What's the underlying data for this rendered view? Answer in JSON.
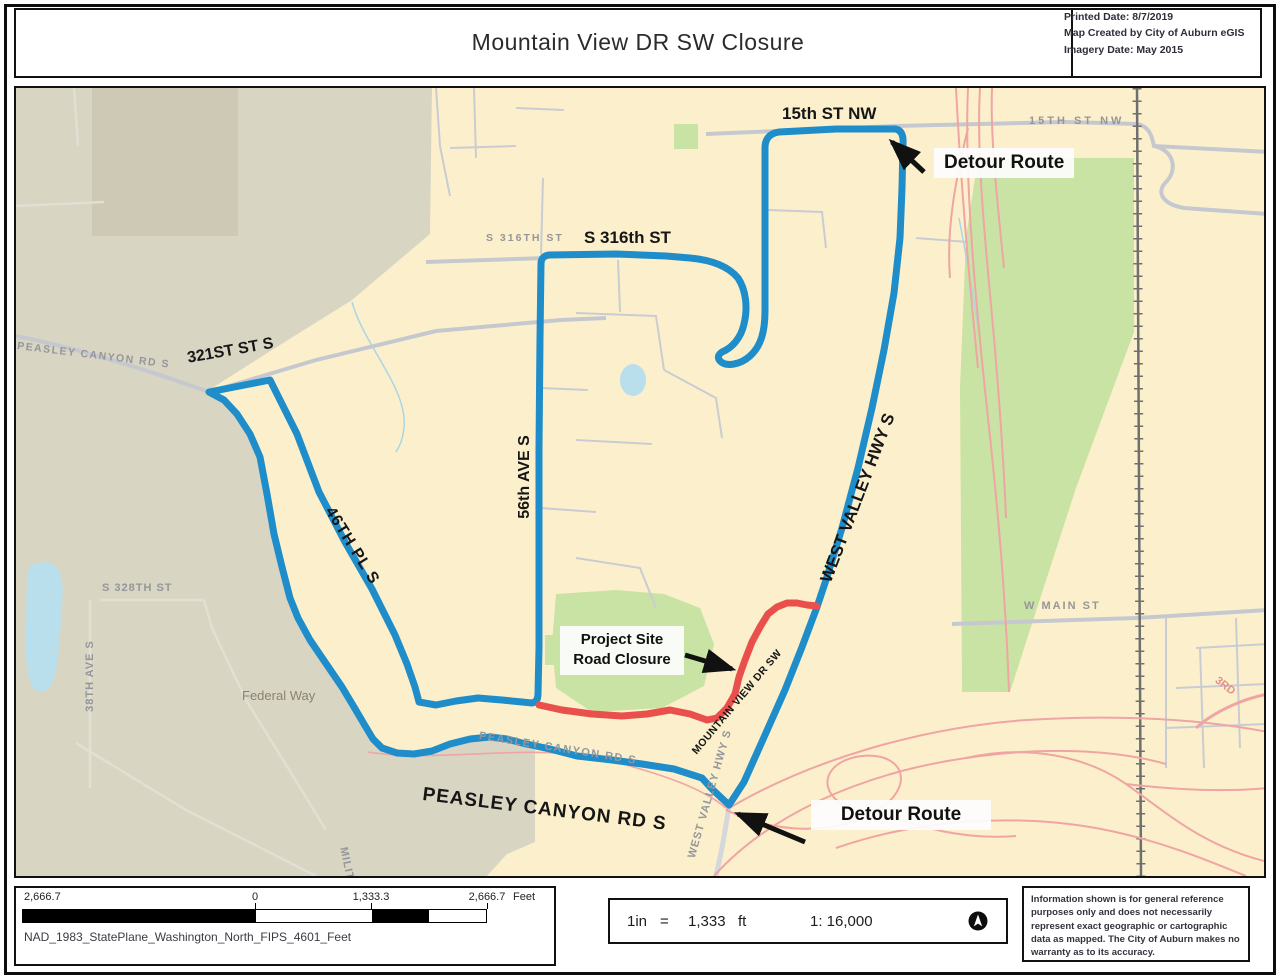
{
  "header": {
    "title": "Mountain View DR SW Closure",
    "meta": [
      "Printed Date:  8/7/2019",
      "Map Created by City of Auburn eGIS",
      "Imagery Date: May 2015"
    ]
  },
  "map": {
    "annotations": {
      "detour_top": "Detour Route",
      "detour_bottom": "Detour Route",
      "project_line1": "Project Site",
      "project_line2": "Road Closure"
    },
    "streets": {
      "s15": "15th ST NW",
      "s316": "S 316th ST",
      "s321": "321ST ST S",
      "ave56": "56th AVE S",
      "pl46": "46TH PL S",
      "wvh": "WEST VALLEY HWY S",
      "peasley": "PEASLEY CANYON RD S",
      "mtview": "MOUNTAIN VIEW DR SW"
    },
    "minor_streets": {
      "g15": "15TH ST NW",
      "g316": "S 316TH ST",
      "gpeasley_nw": "PEASLEY CANYON RD S",
      "gpeasley_s": "PEASLEY CANYON RD S",
      "gwvh": "WEST VALLEY HWY S",
      "gwmain": "W MAIN ST",
      "g328": "S 328TH ST",
      "g38": "38TH AVE S",
      "gmil": "MILITARY RD S",
      "g3rd": "3RD",
      "city": "Federal Way"
    }
  },
  "scalebar": {
    "ticks": [
      "2,666.7",
      "0",
      "1,333.3",
      "2,666.7"
    ],
    "unit": "Feet",
    "datum": "NAD_1983_StatePlane_Washington_North_FIPS_4601_Feet"
  },
  "scale_note": {
    "lhs": "1in",
    "eq": "=",
    "val": "1,333",
    "unit": "ft",
    "ratio": "1: 16,000"
  },
  "disclaimer": "Information shown is for general reference purposes only and does not necessarily represent exact geographic or cartographic data as mapped. The City of Auburn makes no warranty as to its accuracy.",
  "colors": {
    "detour_route": "#1e8dca",
    "road_closure": "#e94f4b"
  }
}
